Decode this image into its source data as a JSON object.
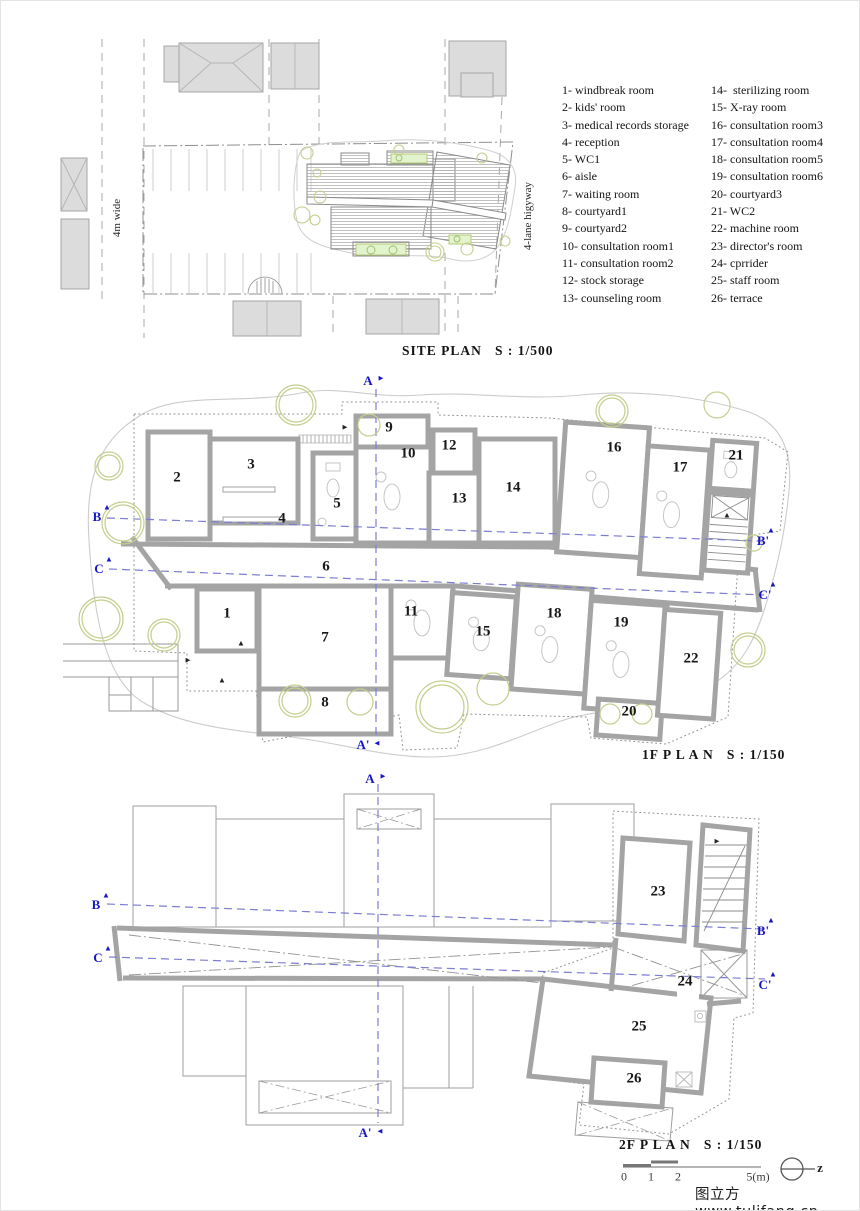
{
  "site_plan": {
    "title": "SITE PLAN   S : 1/500",
    "road_left": "4m wide",
    "road_right": "4-lane higyway"
  },
  "legend": {
    "column1": [
      "1- windbreak room",
      "2- kids' room",
      "3- medical records storage",
      "4- reception",
      "5- WC1",
      "6- aisle",
      "7- waiting room",
      "8- courtyard1",
      "9- courtyard2",
      "10- consultation room1",
      "11- consultation room2",
      "12- stock storage",
      "13- counseling room"
    ],
    "column2": [
      "14-  sterilizing room",
      "15- X-ray room",
      "16- consultation room3",
      "17- consultation room4",
      "18- consultation room5",
      "19- consultation room6",
      "20- courtyard3",
      "21- WC2",
      "22- machine room",
      "23- director's room",
      "24- cprrider",
      "25- staff room",
      "26- terrace"
    ]
  },
  "floor1": {
    "title": "1F P L A N   S : 1/150",
    "room_labels": [
      {
        "t": "1",
        "x": 226,
        "y": 613,
        "cls": "room-num"
      },
      {
        "t": "2",
        "x": 176,
        "y": 477,
        "cls": "room-num"
      },
      {
        "t": "3",
        "x": 250,
        "y": 464,
        "cls": "room-num"
      },
      {
        "t": "4",
        "x": 281,
        "y": 518,
        "cls": "room-num"
      },
      {
        "t": "5",
        "x": 336,
        "y": 503,
        "cls": "room-num"
      },
      {
        "t": "6",
        "x": 325,
        "y": 566,
        "cls": "room-num"
      },
      {
        "t": "7",
        "x": 324,
        "y": 637,
        "cls": "room-num"
      },
      {
        "t": "8",
        "x": 324,
        "y": 702,
        "cls": "room-num"
      },
      {
        "t": "9",
        "x": 388,
        "y": 427,
        "cls": "room-num"
      },
      {
        "t": "10",
        "x": 407,
        "y": 453,
        "cls": "room-num"
      },
      {
        "t": "11",
        "x": 410,
        "y": 611,
        "cls": "room-num"
      },
      {
        "t": "12",
        "x": 448,
        "y": 445,
        "cls": "room-num"
      },
      {
        "t": "13",
        "x": 458,
        "y": 498,
        "cls": "room-num"
      },
      {
        "t": "14",
        "x": 512,
        "y": 487,
        "cls": "room-num"
      },
      {
        "t": "15",
        "x": 482,
        "y": 631,
        "cls": "room-num"
      },
      {
        "t": "16",
        "x": 613,
        "y": 447,
        "cls": "room-num"
      },
      {
        "t": "17",
        "x": 679,
        "y": 467,
        "cls": "room-num"
      },
      {
        "t": "18",
        "x": 553,
        "y": 613,
        "cls": "room-num"
      },
      {
        "t": "19",
        "x": 620,
        "y": 622,
        "cls": "room-num"
      },
      {
        "t": "20",
        "x": 628,
        "y": 711,
        "cls": "room-num"
      },
      {
        "t": "21",
        "x": 735,
        "y": 455,
        "cls": "room-num"
      },
      {
        "t": "22",
        "x": 690,
        "y": 658,
        "cls": "room-num"
      }
    ],
    "markers": [
      {
        "t": "A",
        "x": 367,
        "y": 380,
        "cls": "marker"
      },
      {
        "t": "►",
        "x": 380,
        "y": 377,
        "cls": "arrow-blue"
      },
      {
        "t": "A'",
        "x": 362,
        "y": 744,
        "cls": "marker"
      },
      {
        "t": "◄",
        "x": 376,
        "y": 742,
        "cls": "arrow-blue"
      },
      {
        "t": "B",
        "x": 96,
        "y": 516,
        "cls": "marker"
      },
      {
        "t": "▲",
        "x": 106,
        "y": 506,
        "cls": "arrow-blue"
      },
      {
        "t": "C",
        "x": 98,
        "y": 568,
        "cls": "marker"
      },
      {
        "t": "▲",
        "x": 108,
        "y": 558,
        "cls": "arrow-blue"
      },
      {
        "t": "B'",
        "x": 762,
        "y": 540,
        "cls": "marker"
      },
      {
        "t": "▲",
        "x": 770,
        "y": 529,
        "cls": "arrow-blue"
      },
      {
        "t": "C'",
        "x": 764,
        "y": 594,
        "cls": "marker"
      },
      {
        "t": "▲",
        "x": 772,
        "y": 583,
        "cls": "arrow-blue"
      },
      {
        "t": "►",
        "x": 187,
        "y": 659,
        "cls": "arrow-black"
      },
      {
        "t": "▲",
        "x": 240,
        "y": 642,
        "cls": "arrow-black"
      },
      {
        "t": "▲",
        "x": 221,
        "y": 679,
        "cls": "arrow-black"
      },
      {
        "t": "►",
        "x": 344,
        "y": 426,
        "cls": "arrow-black"
      },
      {
        "t": "▲",
        "x": 726,
        "y": 514,
        "cls": "arrow-black"
      }
    ]
  },
  "floor2": {
    "title": "2F P L A N   S : 1/150",
    "room_labels": [
      {
        "t": "23",
        "x": 657,
        "y": 891,
        "cls": "room-num"
      },
      {
        "t": "24",
        "x": 684,
        "y": 981,
        "cls": "room-num"
      },
      {
        "t": "25",
        "x": 638,
        "y": 1026,
        "cls": "room-num"
      },
      {
        "t": "26",
        "x": 633,
        "y": 1078,
        "cls": "room-num"
      }
    ],
    "markers": [
      {
        "t": "A",
        "x": 369,
        "y": 778,
        "cls": "marker"
      },
      {
        "t": "►",
        "x": 382,
        "y": 775,
        "cls": "arrow-blue"
      },
      {
        "t": "A'",
        "x": 364,
        "y": 1132,
        "cls": "marker"
      },
      {
        "t": "◄",
        "x": 379,
        "y": 1130,
        "cls": "arrow-blue"
      },
      {
        "t": "B",
        "x": 95,
        "y": 904,
        "cls": "marker"
      },
      {
        "t": "▲",
        "x": 105,
        "y": 894,
        "cls": "arrow-blue"
      },
      {
        "t": "C",
        "x": 97,
        "y": 957,
        "cls": "marker"
      },
      {
        "t": "▲",
        "x": 107,
        "y": 947,
        "cls": "arrow-blue"
      },
      {
        "t": "B'",
        "x": 762,
        "y": 930,
        "cls": "marker"
      },
      {
        "t": "▲",
        "x": 770,
        "y": 919,
        "cls": "arrow-blue"
      },
      {
        "t": "C'",
        "x": 764,
        "y": 984,
        "cls": "marker"
      },
      {
        "t": "▲",
        "x": 772,
        "y": 973,
        "cls": "arrow-blue"
      },
      {
        "t": "►",
        "x": 716,
        "y": 840,
        "cls": "arrow-black"
      }
    ]
  },
  "footer": {
    "scale_ticks": [
      {
        "t": "0",
        "x": 623,
        "y": 1176,
        "cls": "tick"
      },
      {
        "t": "1",
        "x": 650,
        "y": 1176,
        "cls": "tick"
      },
      {
        "t": "2",
        "x": 677,
        "y": 1176,
        "cls": "tick"
      },
      {
        "t": "5(m)",
        "x": 757,
        "y": 1176,
        "cls": "tick"
      }
    ],
    "north": [
      {
        "t": "z",
        "x": 819,
        "y": 1167,
        "cls": "north-z"
      }
    ],
    "watermark": "图立方www.tulifang.cn"
  },
  "colors": {
    "wall": "#a4a4a4",
    "section_line": "#7d7dd2",
    "marker_text": "#1717c4",
    "tree": "#c3cf8d",
    "green_fill": "#e2f3cd",
    "building_fill": "#dcdcdc"
  }
}
